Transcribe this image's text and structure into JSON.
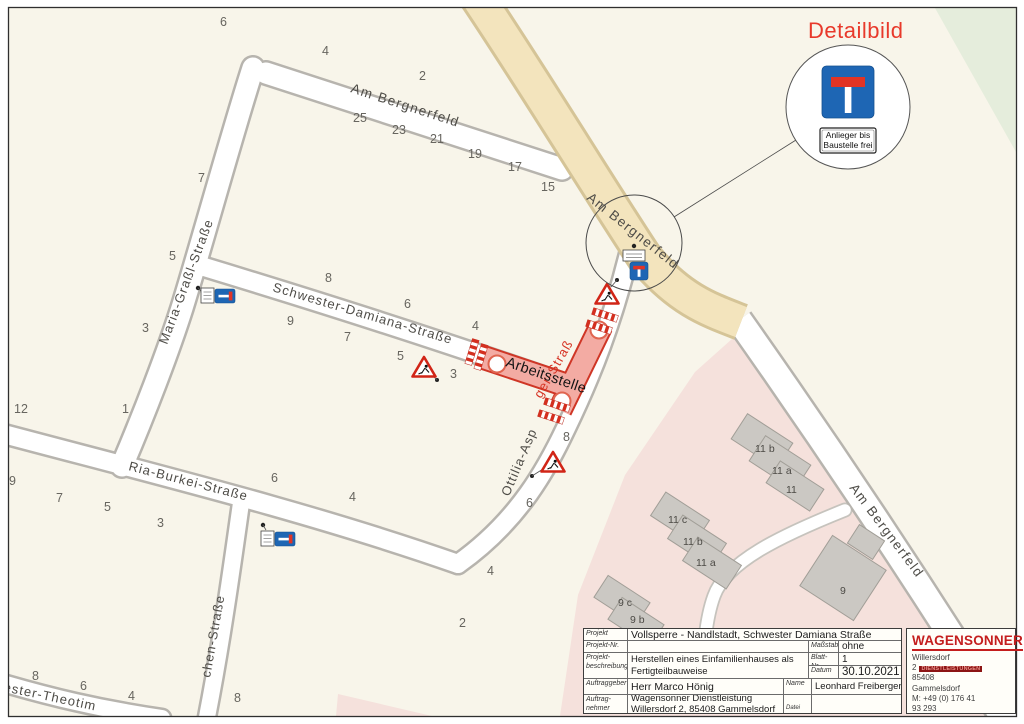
{
  "colors": {
    "map_bg": "#f8f5ea",
    "detail_red": "#e8392b",
    "sign_blue": "#1e66b4",
    "closure_fill": "#f3aba3",
    "closure_edge": "#cf3626",
    "logo_red": "#c41e1e",
    "residential_pink": "#f5e1dc",
    "green_area": "#e5eddc",
    "main_road_tan": "#f3e4bd"
  },
  "detail": {
    "title": "Detailbild",
    "plate_line1": "Anlieger bis",
    "plate_line2": "Baustelle frei"
  },
  "map": {
    "labels": {
      "am_bergnerfeld_north": "Am Bergnerfeld",
      "am_bergnerfeld_main": "Am Bergnerfeld",
      "am_bergnerfeld_south": "Am Bergnerfeld",
      "maria_grassl": "Maria-Graßl-Straße",
      "schwester_damiana": "Schwester-Damiana-Straße",
      "ria_burkei": "Ria-Burkei-Straße",
      "ottilia_black": "Ottilia-Asp",
      "ottilia_red": "ger-Straß",
      "chen": "chen-Straße",
      "theotim": "ester-Theotim",
      "arbeitsstelle": "Arbeitsstelle"
    },
    "house_numbers": [
      "6",
      "4",
      "2",
      "25",
      "23",
      "21",
      "19",
      "17",
      "15",
      "7",
      "5",
      "3",
      "8",
      "9",
      "7",
      "6",
      "5",
      "4",
      "3",
      "1",
      "12",
      "9",
      "7",
      "5",
      "3",
      "6",
      "4",
      "8",
      "6",
      "4",
      "8",
      "4",
      "2",
      "8",
      "6"
    ],
    "building_labels": [
      "11 b",
      "11 a",
      "11",
      "11 c",
      "11 b",
      "11 a",
      "9 c",
      "9 b",
      "9"
    ]
  },
  "titleblock": {
    "projekt_label": "Projekt",
    "projekt_value": "Vollsperre - Nandlstadt, Schwester Damiana Straße",
    "projekt_nr_label": "Projekt-Nr.",
    "massstab_label": "Maßstab",
    "massstab_value": "ohne",
    "beschreibung_label": "Projekt-beschreibung",
    "beschreibung_value_line1": "Herstellen eines Einfamilienhauses als",
    "beschreibung_value_line2": "Fertigteilbauweise",
    "blatt_label": "Blatt-Nr.",
    "blatt_value": "1",
    "datum_label": "Datum",
    "datum_value": "30.10.2021",
    "auftraggeber_label": "Auftraggeber",
    "auftraggeber_value": "Herr Marco Hönig",
    "name_label": "Name",
    "name_value": "Leonhard Freiberger",
    "auftragnehmer_label": "Auftrag-nehmer",
    "auftragnehmer_value_line1": "Wagensonner Dienstleistung",
    "auftragnehmer_value_line2": "Willersdorf 2, 85408 Gammelsdorf",
    "datei_label": "Datei"
  },
  "logo": {
    "name": "WAGENSONNER",
    "badge": "DIENSTLEISTUNGEN",
    "address_line1": "Willersdorf 2",
    "address_line2": "85408",
    "address_line3": "Gammelsdorf",
    "phone_line1": "M: +49 (0) 176 41",
    "phone_line2": "93 293"
  }
}
